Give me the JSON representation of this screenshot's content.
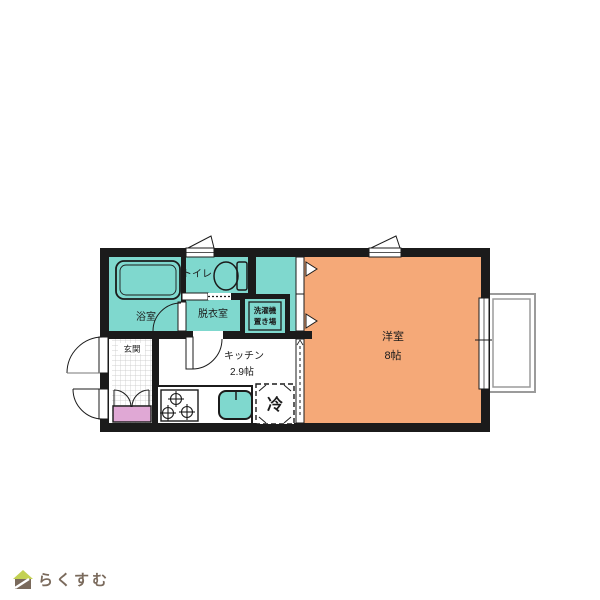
{
  "colors": {
    "room_teal": "#7fd8ce",
    "room_orange": "#f5a978",
    "wall_black": "#1b1b1b",
    "shoebox_pink": "#e0a8d5",
    "balcony_gray": "#9b9b9b",
    "tile_gray": "#c4c4c4",
    "logo_brown": "#7a6a5c",
    "logo_green": "#c3d153"
  },
  "floorplan": {
    "rooms": {
      "bathroom": {
        "label": "浴室"
      },
      "toilet": {
        "label": "トイレ"
      },
      "dressing_room": {
        "label": "脱衣室"
      },
      "laundry_space": {
        "label_line1": "洗濯機",
        "label_line2": "置き場"
      },
      "entrance": {
        "label": "玄関"
      },
      "kitchen": {
        "label": "キッチン",
        "size": "2.9帖"
      },
      "western_room": {
        "label": "洋室",
        "size": "8帖"
      },
      "refrigerator_space": {
        "label": "冷"
      }
    }
  },
  "footer": {
    "logo_text": "らくすむ"
  }
}
